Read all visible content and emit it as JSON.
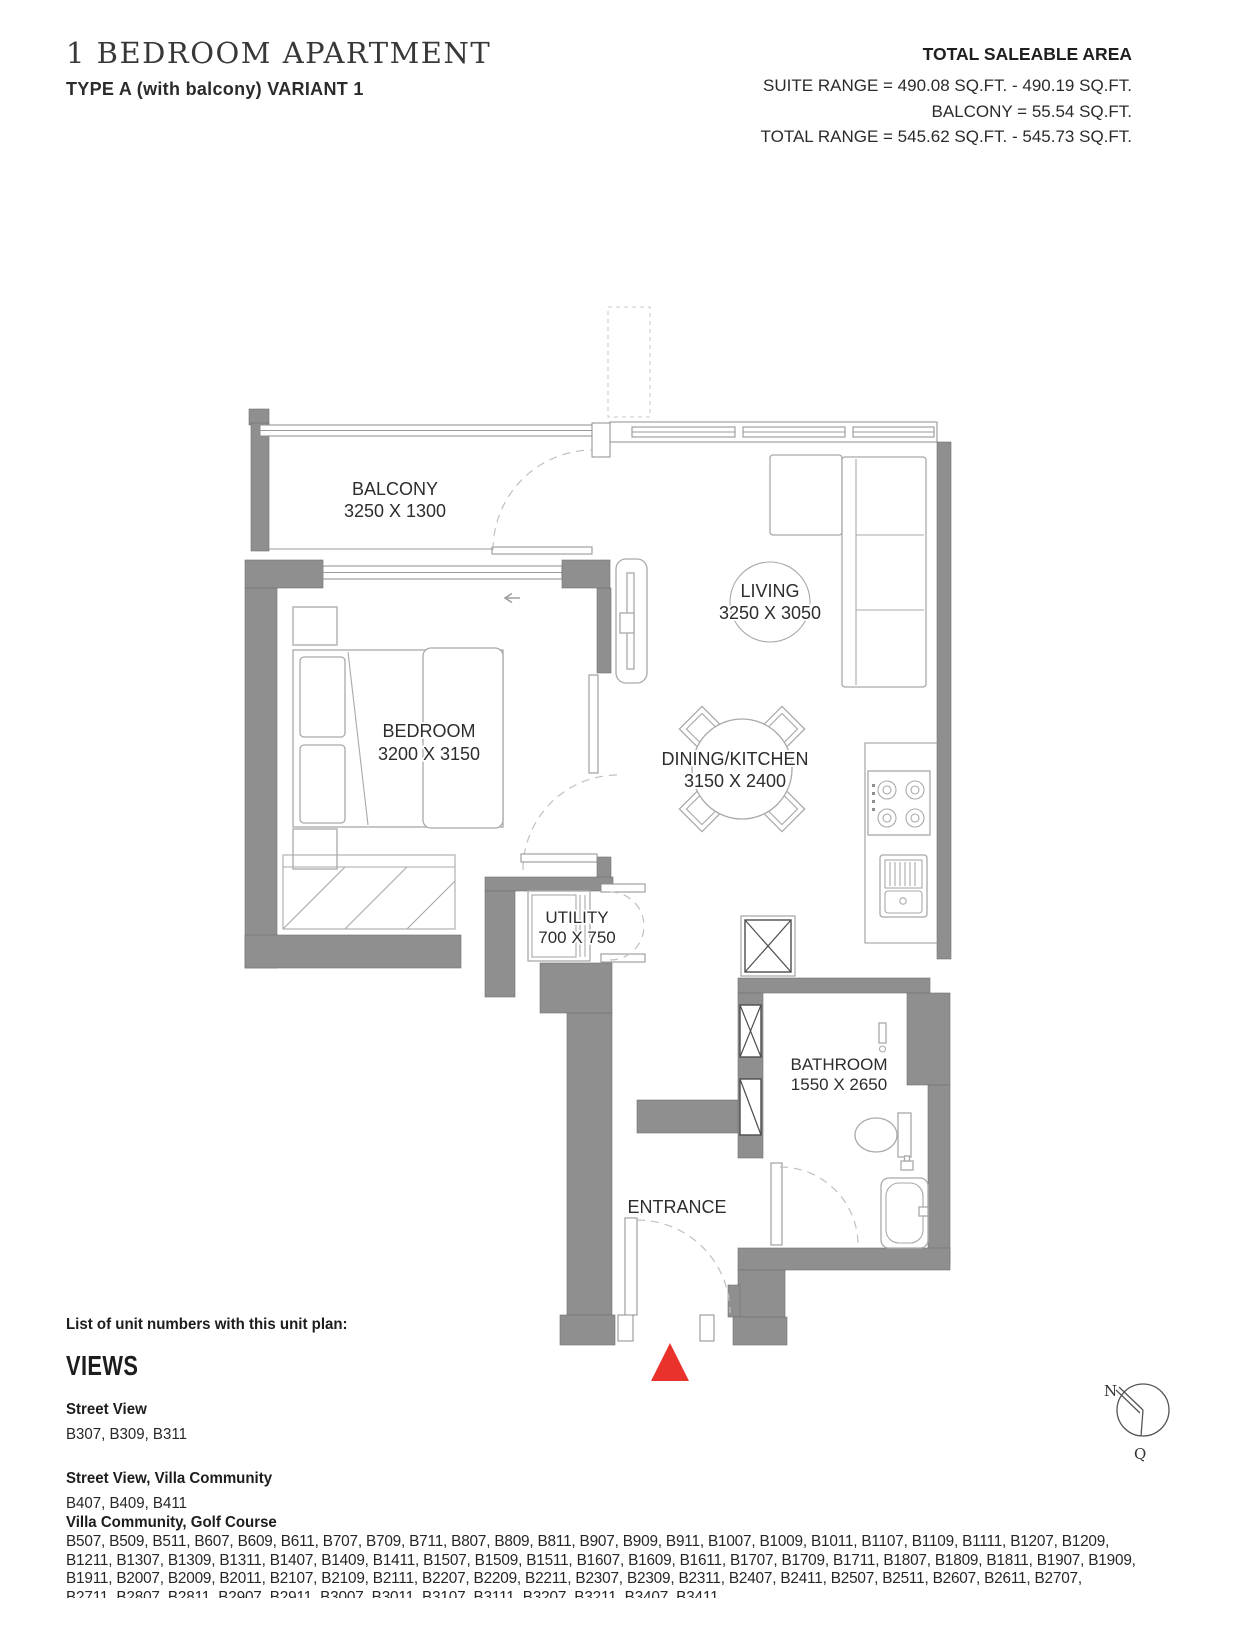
{
  "header": {
    "title": "1 BEDROOM APARTMENT",
    "subtitle": "TYPE A (with balcony) VARIANT 1",
    "saleable": {
      "heading": "TOTAL SALEABLE AREA",
      "suite_range": "SUITE RANGE = 490.08 SQ.FT. -  490.19 SQ.FT.",
      "balcony": "BALCONY = 55.54 SQ.FT.",
      "total_range": "TOTAL RANGE = 545.62 SQ.FT. - 545.73 SQ.FT."
    }
  },
  "plan": {
    "rooms": {
      "balcony": {
        "name": "BALCONY",
        "dims": "3250 X 1300"
      },
      "living": {
        "name": "LIVING",
        "dims": "3250 X 3050"
      },
      "bedroom": {
        "name": "BEDROOM",
        "dims": "3200 X 3150"
      },
      "dining_kitchen": {
        "name": "DINING/KITCHEN",
        "dims": "3150 X 2400"
      },
      "utility": {
        "name": "UTILITY",
        "dims": "700 X 750"
      },
      "bathroom": {
        "name": "BATHROOM",
        "dims": "1550 X 2650"
      },
      "entrance": {
        "name": "ENTRANCE"
      }
    },
    "compass": {
      "north_label": "N",
      "south_label": "Q"
    }
  },
  "footer": {
    "list_intro": "List of unit numbers with this unit plan:",
    "views_heading": "VIEWS",
    "groups": [
      {
        "label": "Street View",
        "units": [
          "B307, B309, B311"
        ]
      },
      {
        "label": "Street View, Villa Community",
        "units": [
          "B407, B409, B411"
        ]
      },
      {
        "label": "Villa Community, Golf Course",
        "units": [
          "B507, B509, B511, B607, B609, B611, B707, B709, B711, B807, B809, B811, B907, B909, B911, B1007, B1009, B1011, B1107, B1109, B1111, B1207, B1209,",
          "B1211, B1307, B1309, B1311, B1407, B1409, B1411, B1507, B1509, B1511, B1607, B1609, B1611, B1707, B1709, B1711, B1807, B1809, B1811, B1907, B1909,",
          "B1911, B2007, B2009, B2011, B2107, B2109, B2111, B2207, B2209, B2211, B2307, B2309, B2311, B2407, B2411, B2507, B2511, B2607, B2611, B2707,",
          "B2711, B2807, B2811, B2907, B2911, B3007, B3011, B3107, B3111, B3207, B3211, B3407, B3411"
        ]
      }
    ]
  },
  "colors": {
    "wall": "#8f8f8f",
    "red_marker": "#e8322b"
  }
}
